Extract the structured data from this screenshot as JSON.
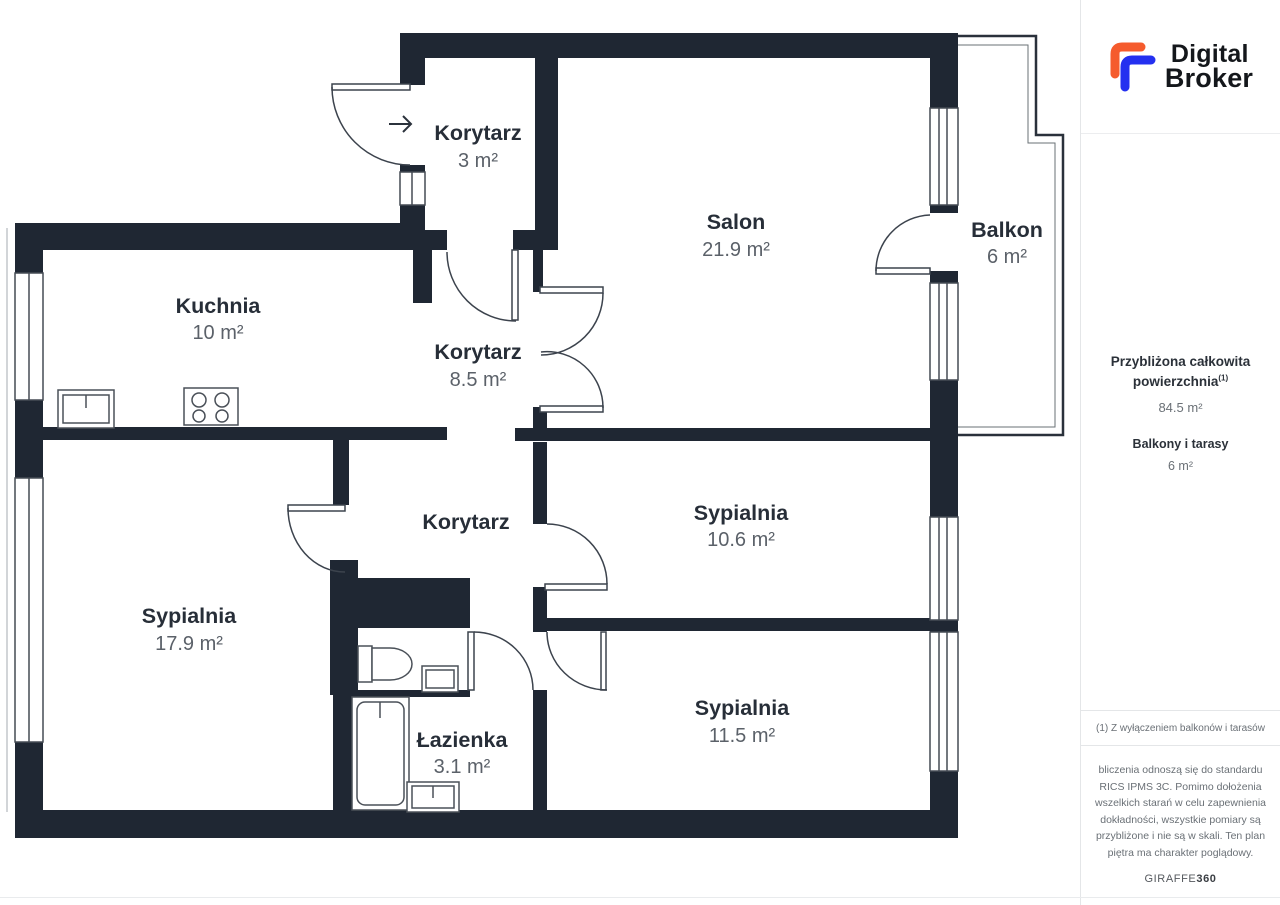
{
  "brand": {
    "line1": "Digital",
    "line2": "Broker",
    "mark_orange": "#F55B2D",
    "mark_blue": "#2430F0"
  },
  "plan": {
    "wall_color": "#1F2733",
    "entrance_arrow": "→"
  },
  "rooms": {
    "hall_top": {
      "name": "Korytarz",
      "area": "3 m²"
    },
    "salon": {
      "name": "Salon",
      "area": "21.9 m²"
    },
    "balcony": {
      "name": "Balkon",
      "area": "6 m²"
    },
    "kitchen": {
      "name": "Kuchnia",
      "area": "10 m²"
    },
    "hall_mid": {
      "name": "Korytarz",
      "area": "8.5 m²"
    },
    "hall_lower": {
      "name": "Korytarz"
    },
    "bedroom_1": {
      "name": "Sypialnia",
      "area": "10.6 m²"
    },
    "bedroom_2": {
      "name": "Sypialnia",
      "area": "17.9 m²"
    },
    "bedroom_3": {
      "name": "Sypialnia",
      "area": "11.5 m²"
    },
    "bathroom": {
      "name": "Łazienka",
      "area": "3.1 m²"
    }
  },
  "summary": {
    "title_line1": "Przybliżona całkowita",
    "title_line2": "powierzchnia",
    "title_sup": "(1)",
    "total_value": "84.5 m²",
    "subtitle": "Balkony i tarasy",
    "sub_value": "6 m²"
  },
  "footnote": "(1) Z wyłączeniem balkonów i tarasów",
  "disclaimer": "bliczenia odnoszą się do standardu RICS IPMS 3C. Pomimo dołożenia wszelkich starań w celu zapewnienia dokładności, wszystkie pomiary są przybliżone i nie są w skali. Ten plan piętra ma charakter poglądowy.",
  "watermark": {
    "brand": "GIRAFFE",
    "suffix": "360"
  }
}
